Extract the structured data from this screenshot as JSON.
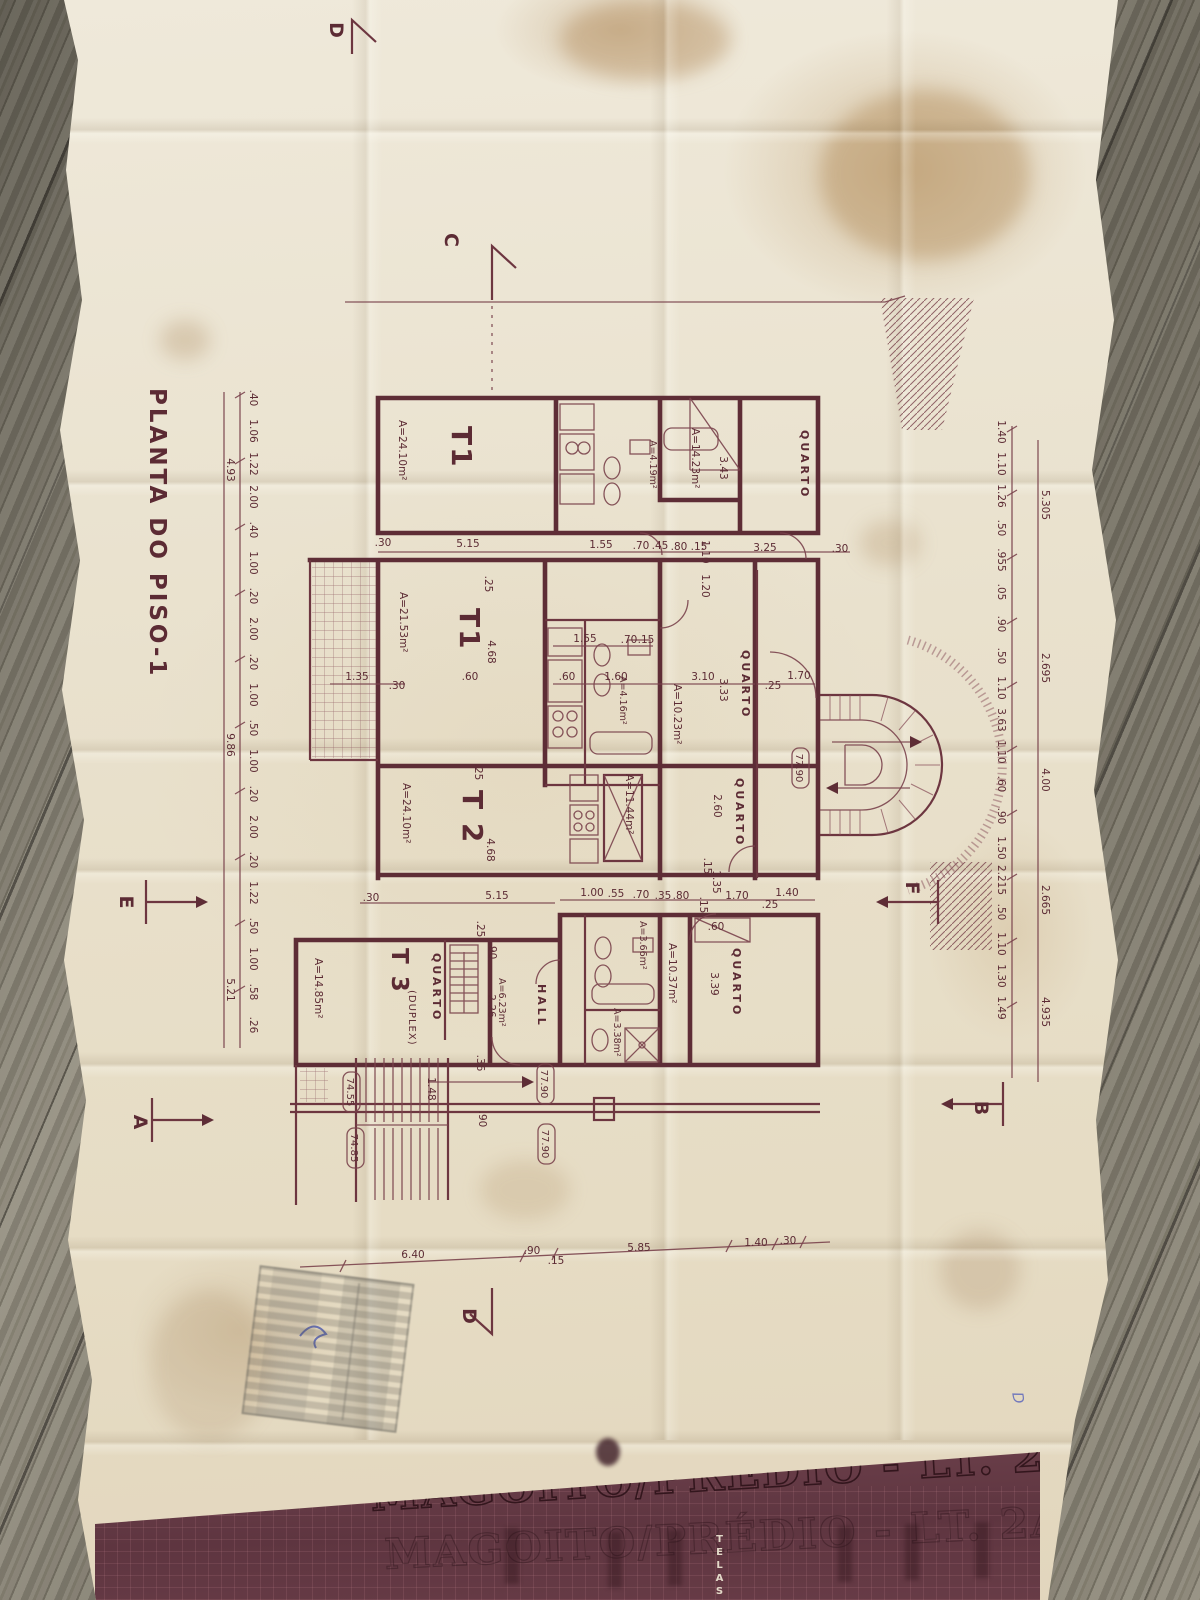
{
  "drawing": {
    "plan_title": "PLANTA DO PISO-1",
    "units": {
      "t1_top": {
        "label": "T1",
        "area": "A=24.10m²"
      },
      "t1_mid": {
        "label": "T1",
        "area": "A=21.53m²"
      },
      "t2": {
        "label": "T 2",
        "area": "A=24.10m²"
      },
      "t3": {
        "label": "T 3",
        "suffix": "(DUPLEX)",
        "area": "A=14.85m²"
      }
    },
    "rooms": {
      "quarto": "QUARTO",
      "hall": "HALL"
    },
    "areas": {
      "bed_top": "A=14.23m²",
      "wc_top": "A=4.19m²",
      "wc_mid": "A=4.16m²",
      "bed_mid": "A=10.23m²",
      "living_mid": "A=11.44m²",
      "wc_low": "A=3.66m²",
      "wc_low2": "A=3.38m²",
      "bed_low": "A=10.37m²",
      "hall_low": "A=6.23m²"
    },
    "levels": {
      "walkway": "77.90",
      "stair_upper": "74.55",
      "stair_lower": "74.85"
    },
    "sections": {
      "a": "A",
      "b": "B",
      "c": "C",
      "d": "D",
      "e": "E",
      "f": "F"
    },
    "dims": {
      "row_top": [
        ".30",
        "5.15",
        "1.55",
        ".70",
        ".45",
        ".80",
        ".15",
        "3.25",
        ".30"
      ],
      "row_kitchen": [
        "1.55",
        ".70",
        ".15",
        ".60",
        "1.60",
        "3.10",
        ".60",
        "1.35",
        ".30",
        "1.70",
        ".25"
      ],
      "row_low": [
        ".30",
        "5.15",
        "1.00",
        ".55",
        ".70",
        ".35",
        ".80",
        "1.70",
        "1.40",
        ".25"
      ],
      "row_bottom": [
        "6.40",
        ".90",
        ".15",
        "5.85",
        "1.40",
        ".30"
      ],
      "misc": [
        "3.43",
        "1.10",
        "1.20",
        ".25",
        "4.68",
        "3.33",
        "2.60",
        ".15",
        "4.68",
        ".25",
        "1.35",
        "2.26",
        ".90",
        "3.39",
        ".60",
        "1.48",
        ".90",
        ".36",
        ".25",
        ".15"
      ],
      "left_inner": [
        ".40",
        "1.06",
        "1.22",
        "2.00",
        ".40",
        "1.00",
        ".20",
        "2.00",
        ".20",
        "1.00",
        ".50",
        "1.00",
        ".20",
        "2.00",
        ".20",
        "1.22",
        ".50",
        "1.00",
        ".58",
        ".26"
      ],
      "left_outer": [
        "4.93",
        "9.86",
        "5.21"
      ],
      "right_inner": [
        "1.40",
        "1.10",
        "1.26",
        ".50",
        ".955",
        ".05",
        ".90",
        ".50",
        "1.10",
        "3.63",
        "1.10",
        ".60",
        ".90",
        "1.50",
        "2.215",
        ".50",
        "1.10",
        "1.30",
        "1.49"
      ],
      "right_outer": [
        "5.305",
        "2.695",
        "4.00",
        "2.665",
        "4.935"
      ]
    },
    "title_block": {
      "title": "MAGOITO/PRÉDIO - LT. 2A",
      "side_label": "TELAS"
    },
    "pen_mark": "D"
  }
}
